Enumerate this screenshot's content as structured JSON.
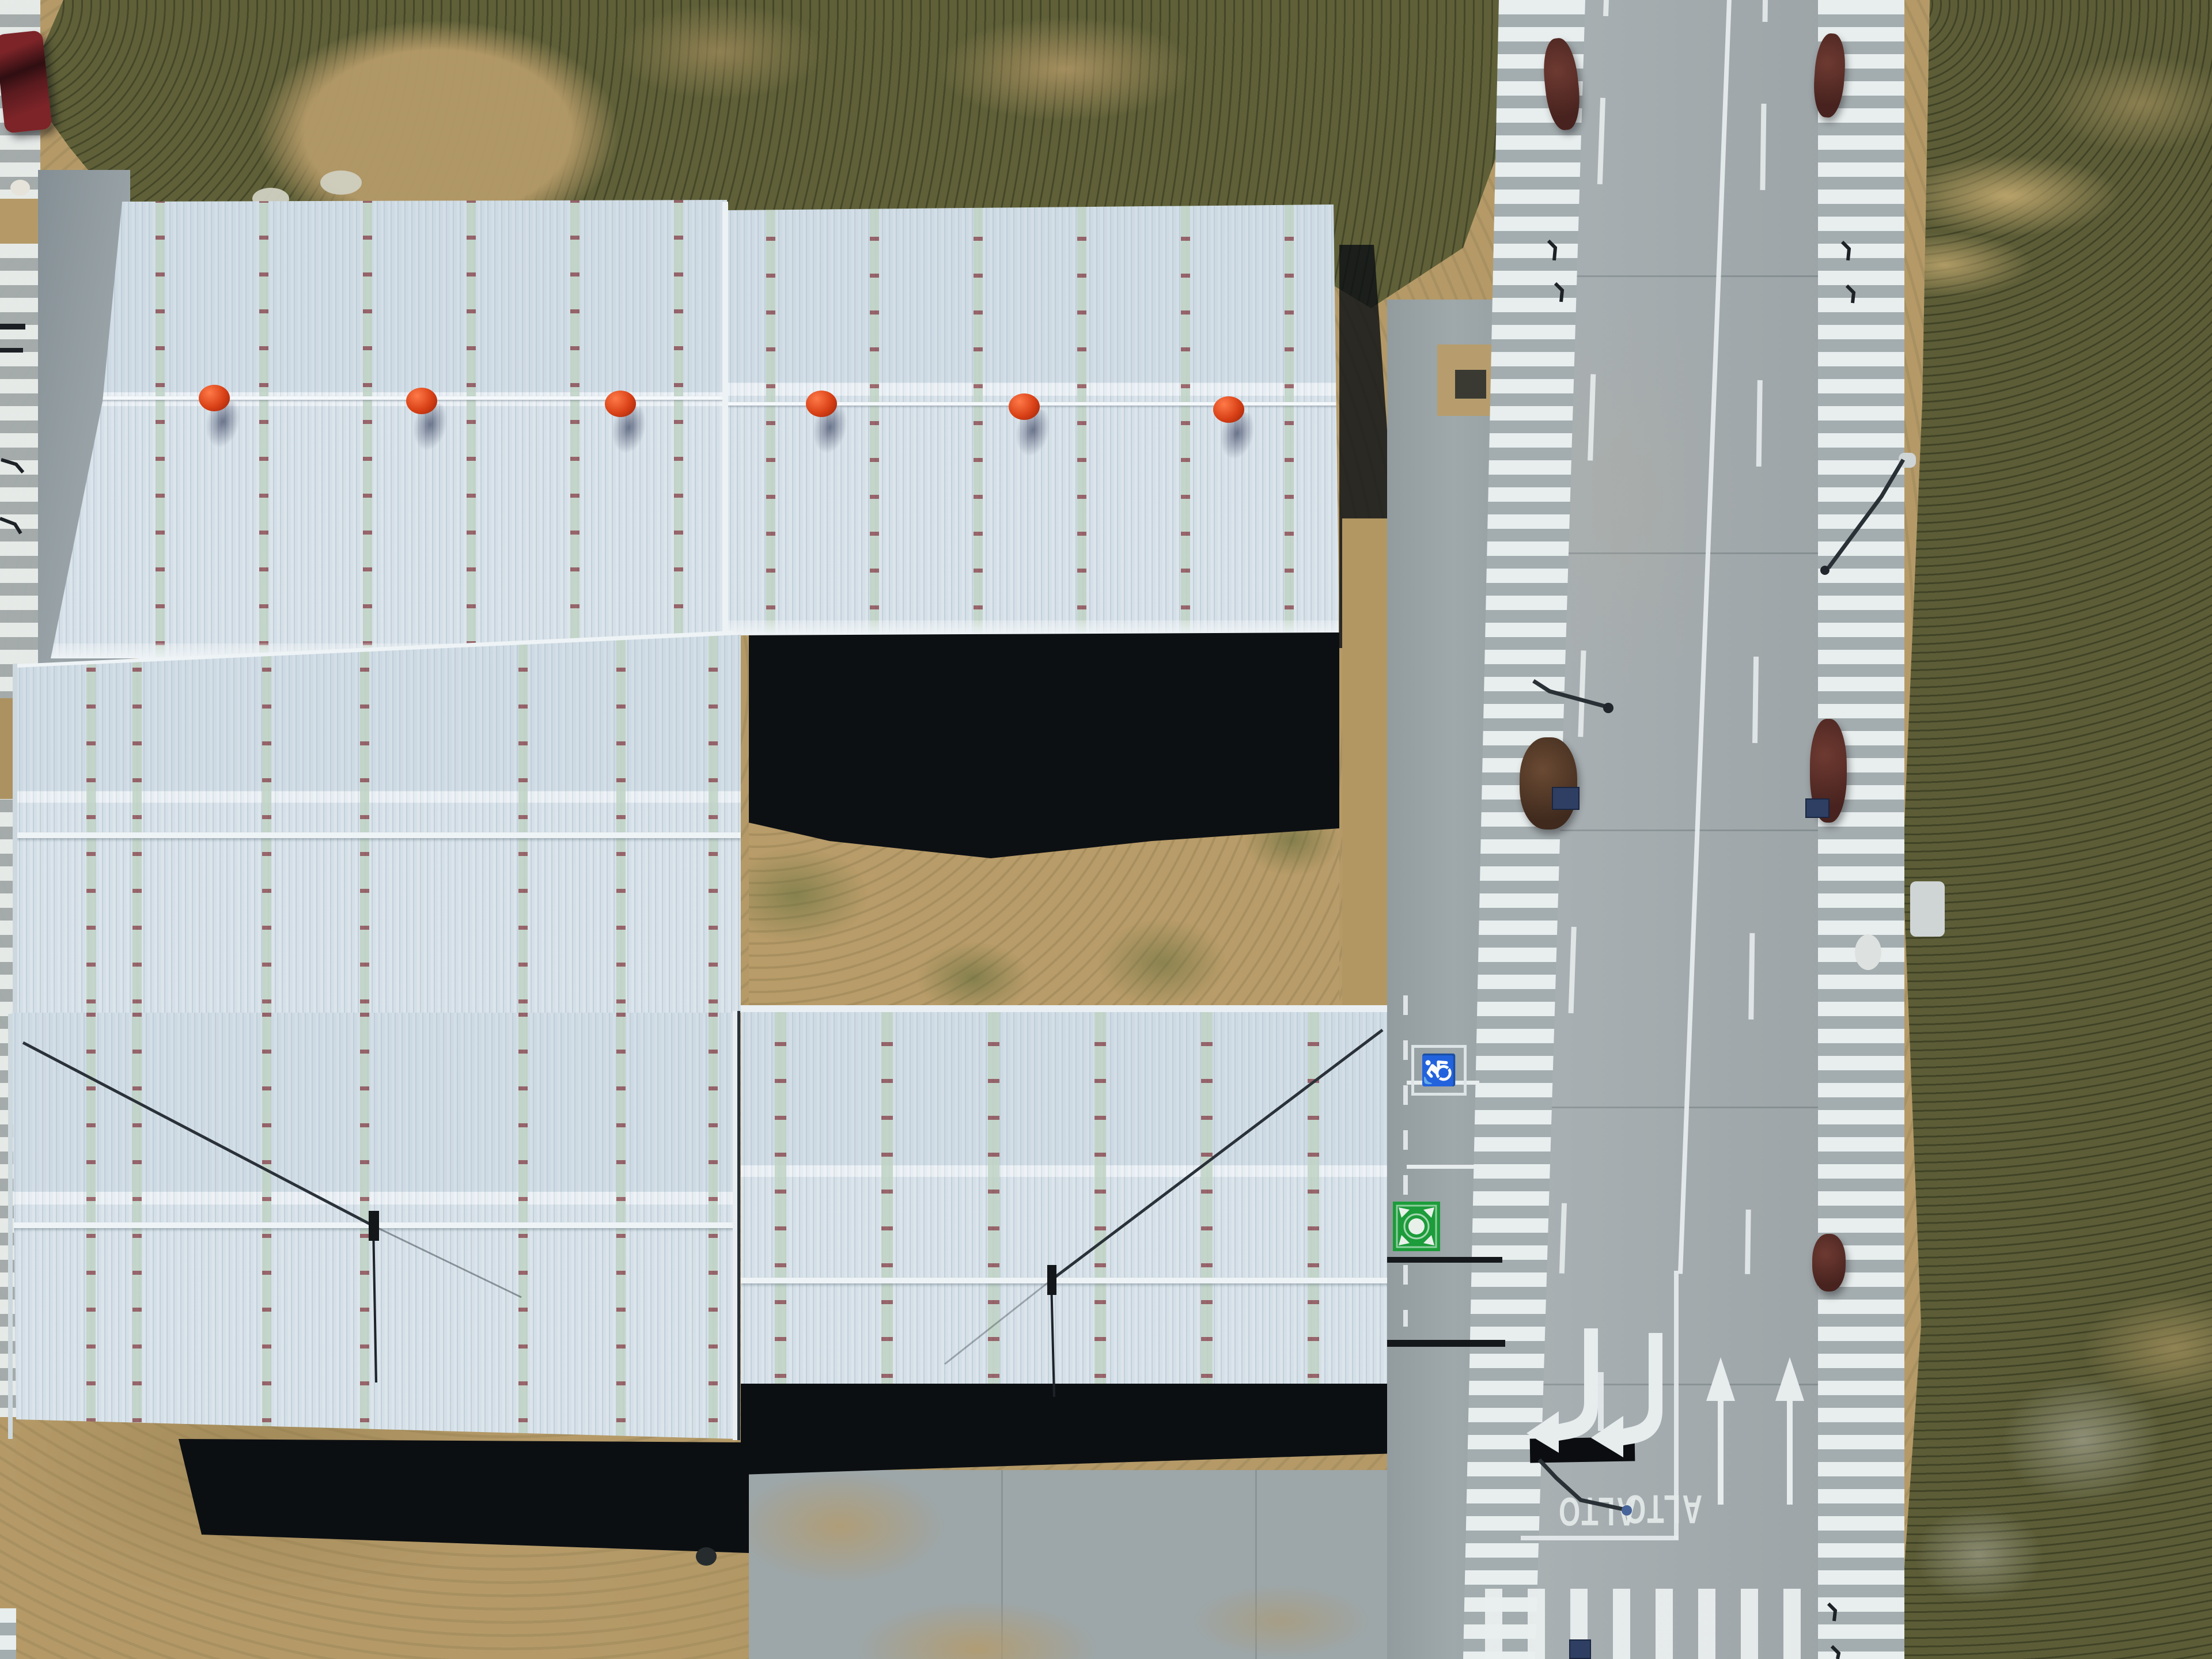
{
  "meta": {
    "scene": "Top-down aerial drone photo of an industrial park: five white corrugated warehouse roofs on the left and a new concrete road with painted markings on the right",
    "time_of_day": "midday, hard shadows cast south-southeast"
  },
  "labels": {
    "stop_text": "ALTO",
    "handicap_symbol": "♿"
  },
  "buildings": {
    "count": 5,
    "roof_material": "white corrugated metal",
    "roof_color": "#dbe5ec",
    "skylight_strip_color": "#c0d3c4",
    "skylight_tick_color": "#7e3a40",
    "ridge_vent_balls": {
      "count": 6,
      "color": "#d84016",
      "position": "along north ridge line"
    },
    "lightning_rods": {
      "count": 2,
      "description": "thin masts with diagonal guy wires anchored on roof seams"
    }
  },
  "road": {
    "surface": "concrete",
    "surface_color": "#a6aeb1",
    "center_line": "solid white, slightly angled",
    "lane_lines": "dashed white",
    "shoulders": "white hatched rumble bands on both edges",
    "stop_text": "ALTO",
    "stop_text_count": 2,
    "stop_text_orientation": "rotated 180° (for southbound traffic)",
    "stop_bar": {
      "shape": "black rectangle",
      "color": "#0b0d10"
    },
    "straight_arrows": 2,
    "left_turn_arrows": 2,
    "crosswalk": "white zebra stripes at bottom intersection",
    "handicap_symbol": "♿",
    "assembly_point_marker": {
      "shape": "green square with white center dot and 4 inward arrows",
      "color": "#1c9c3a"
    },
    "furniture": {
      "street_lights": 3,
      "drain_grates": 3,
      "shrubs_on_shoulder": 5,
      "conduit_stubs": "several small bent pipes along shoulders"
    }
  },
  "terrain": {
    "dirt_color": "#b59a68",
    "scrub_color": "#5f6038",
    "building_shadow_color": "#0c0f12",
    "courtyard": "bare dirt with sparse weeds between the buildings"
  },
  "other_objects": {
    "parked_car": {
      "color": "dark red",
      "location": "top-left corner on striped band"
    },
    "concrete_aprons": "gray sidewalk/verge strips between buildings and road",
    "manhole": "small dark circle south of the left warehouse shadow"
  }
}
